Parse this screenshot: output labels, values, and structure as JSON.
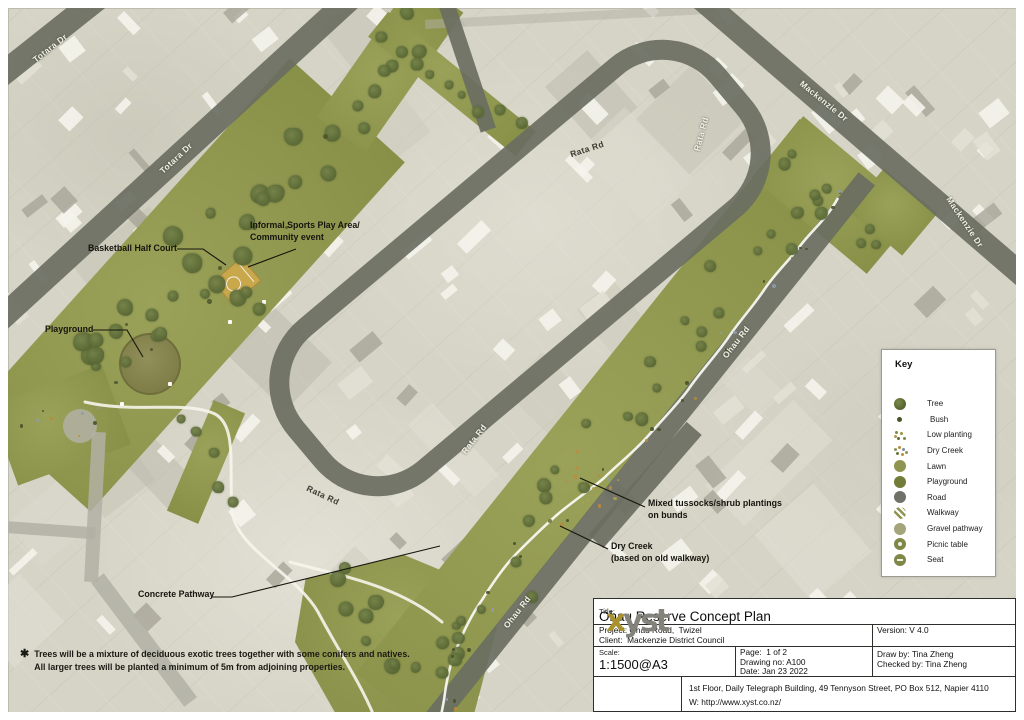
{
  "colors": {
    "lawn_green": "#8f964e",
    "road_overlay": "#6a6e61",
    "tree_green": "#5c6b35",
    "court_gold": "#c9a84c",
    "creek_white": "#fbfbf6",
    "logo_gold": "#a8922f",
    "logo_gray": "#83837b"
  },
  "roads": {
    "labels": [
      {
        "text": "Totara Dr",
        "tone": "light"
      },
      {
        "text": "Totara Dr",
        "tone": "light"
      },
      {
        "text": "Rata Rd",
        "tone": "dark"
      },
      {
        "text": "Rata Rd",
        "tone": "light"
      },
      {
        "text": "Rata Rd",
        "tone": "light"
      },
      {
        "text": "Rata Rd",
        "tone": "dark"
      },
      {
        "text": "Ohau Rd",
        "tone": "light"
      },
      {
        "text": "Ohau Rd",
        "tone": "light"
      },
      {
        "text": "Mackenzie Dr",
        "tone": "light"
      },
      {
        "text": "Mackenzie Dr",
        "tone": "light"
      }
    ]
  },
  "annotations": [
    {
      "l1": "Basketball Half Court",
      "l2": ""
    },
    {
      "l1": "Informal Sports Play Area/",
      "l2": "Community event"
    },
    {
      "l1": "Playground",
      "l2": ""
    },
    {
      "l1": "Mixed tussocks/shrub plantings",
      "l2": "on bunds"
    },
    {
      "l1": "Dry Creek",
      "l2": "(based on old walkway)"
    },
    {
      "l1": "Concrete Pathway",
      "l2": ""
    }
  ],
  "notes": {
    "marker": "✱",
    "line1": "Trees will be a mixture of deciduous exotic trees together with some conifers and natives.",
    "line2": "All larger trees will be planted a minimum of 5m from adjoining properties."
  },
  "key": {
    "title": "Key",
    "items": [
      {
        "icon": "tree",
        "label": "Tree"
      },
      {
        "icon": "bush",
        "label": "Bush"
      },
      {
        "icon": "low-planting",
        "label": "Low planting"
      },
      {
        "icon": "dry-creek",
        "label": "Dry Creek"
      },
      {
        "icon": "lawn",
        "label": "Lawn"
      },
      {
        "icon": "playground",
        "label": "Playground"
      },
      {
        "icon": "road",
        "label": "Road"
      },
      {
        "icon": "walkway",
        "label": "Walkway"
      },
      {
        "icon": "gravel",
        "label": "Gravel pathway"
      },
      {
        "icon": "picnic",
        "label": "Picnic table"
      },
      {
        "icon": "seat",
        "label": "Seat"
      }
    ]
  },
  "title_block": {
    "title_label": "Title:",
    "title": "Ohau Reserve Concept Plan",
    "project": "Project: Ohau Road,  Twizel",
    "client": "Client:  Mackenzie District Council",
    "version": "Version: V 4.0",
    "scale_label": "Scale:",
    "scale": "1:1500@A3",
    "page": "Page:  1 of 2",
    "drawing_no": "Drawing no: A100",
    "date": "Date: Jan 23 2022",
    "draw_by": "Draw by: Tina Zheng",
    "checked_by": "Checked by: Tina Zheng",
    "logo_x": "x",
    "logo_rest": "yst",
    "address": "1st Floor, Daily Telegraph Building, 49 Tennyson Street, PO Box 512, Napier 4110",
    "web": "W: http://www.xyst.co.nz/"
  }
}
